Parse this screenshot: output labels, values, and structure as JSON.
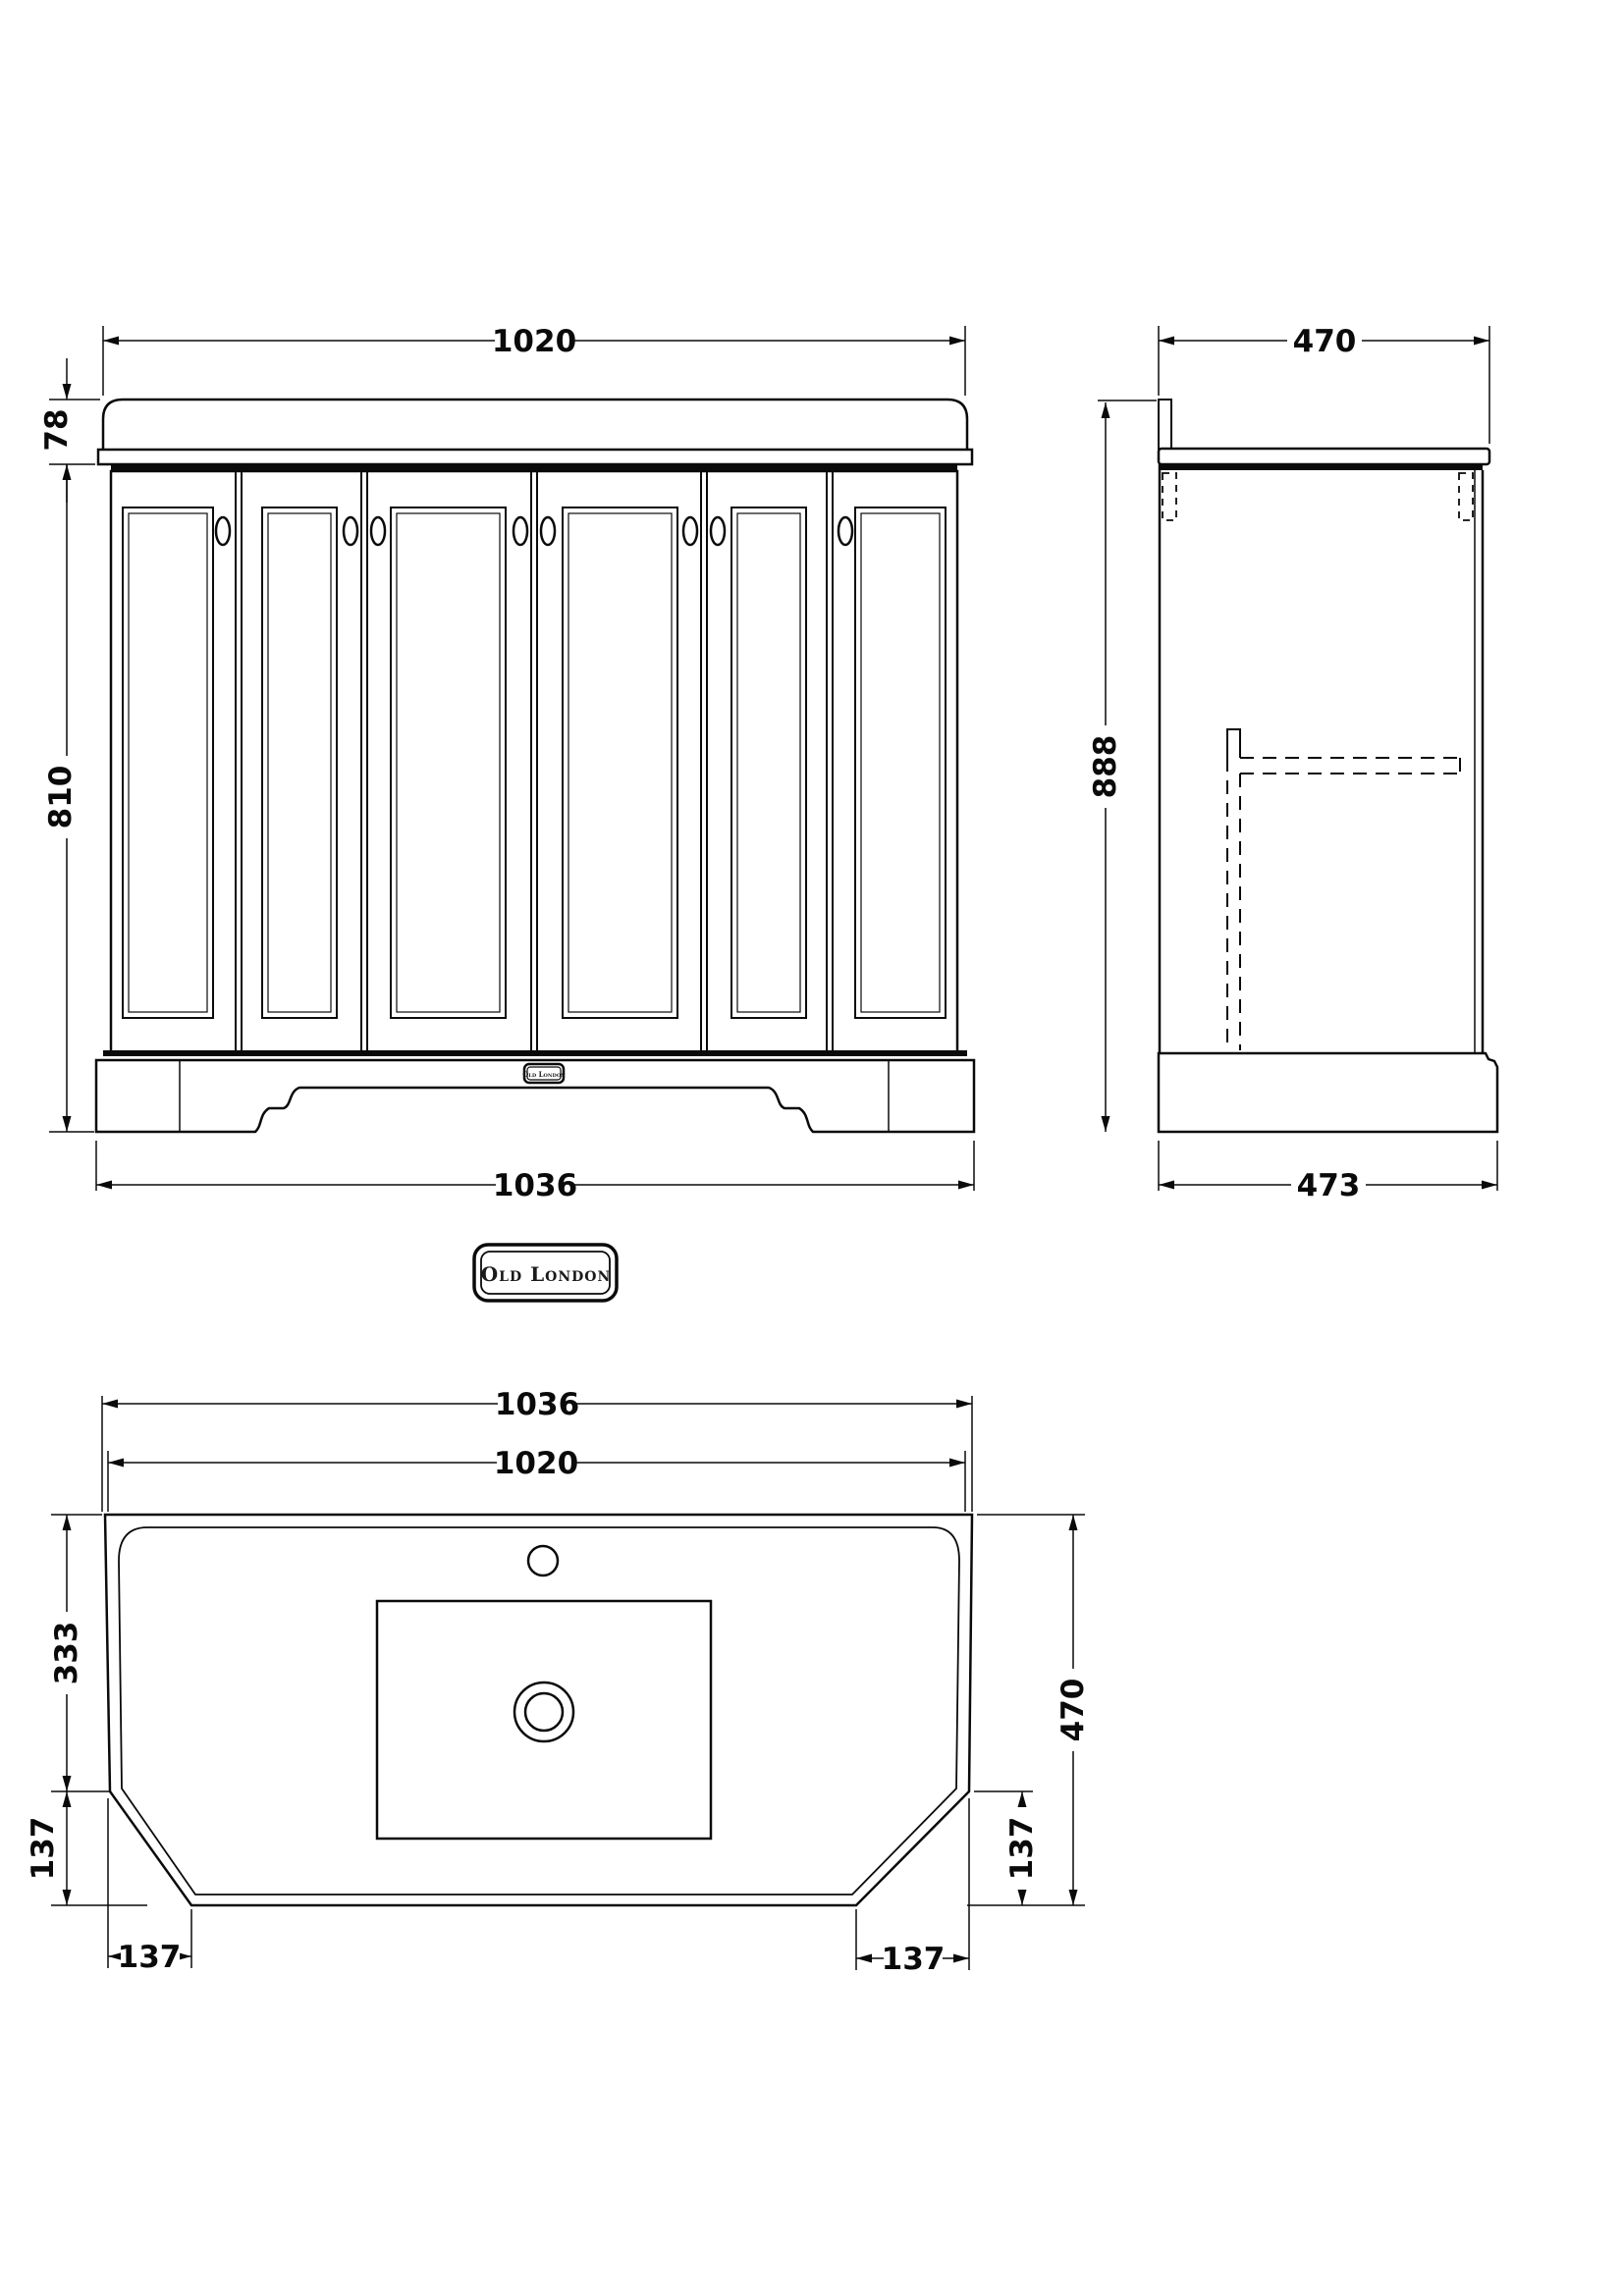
{
  "brand": {
    "badge_text": "Old London",
    "plinth_badge_text": "Old London"
  },
  "front_view": {
    "dim_top_width": "1020",
    "dim_counter_height": "78",
    "dim_body_height": "810",
    "dim_base_width": "1036"
  },
  "side_view": {
    "dim_top_depth": "470",
    "dim_height": "888",
    "dim_base_depth": "473"
  },
  "plan_view": {
    "dim_outer_width": "1036",
    "dim_basin_width": "1020",
    "dim_back_to_chamfer": "333",
    "dim_chamfer_left_vertical": "137",
    "dim_chamfer_left_horizontal": "137",
    "dim_total_depth": "470",
    "dim_chamfer_right_vertical": "137",
    "dim_chamfer_right_horizontal": "137"
  },
  "colors": {
    "line": "#0a0a0a",
    "background": "#ffffff"
  }
}
